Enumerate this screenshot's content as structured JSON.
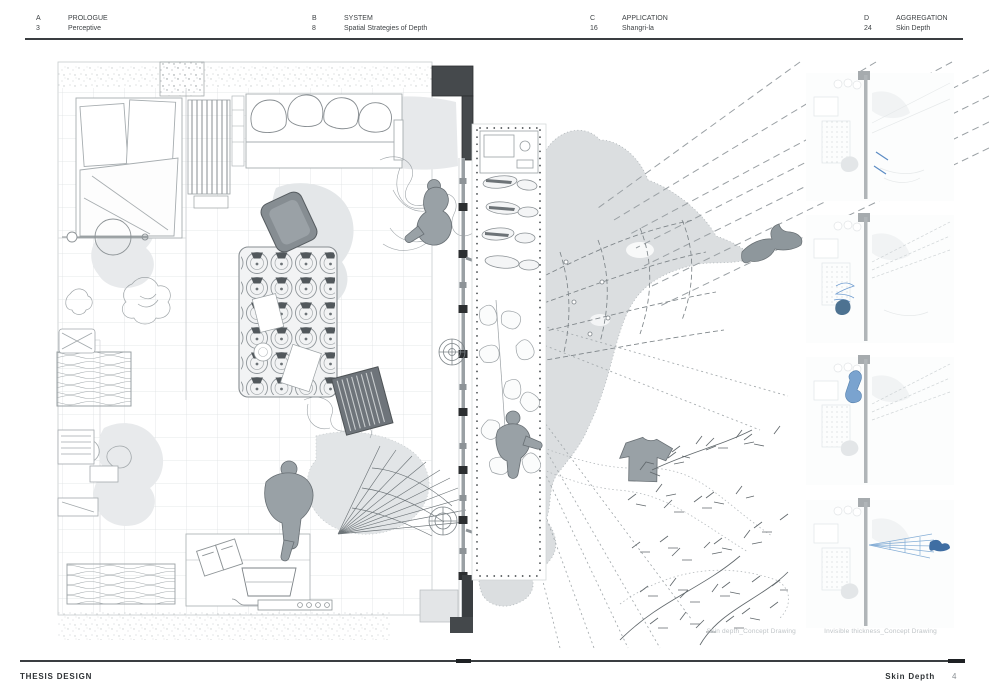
{
  "header": {
    "sections": [
      {
        "letter": "A",
        "number": "3",
        "title": "PROLOGUE",
        "subtitle": "Perceptive"
      },
      {
        "letter": "B",
        "number": "8",
        "title": "SYSTEM",
        "subtitle": "Spatial Strategies of Depth"
      },
      {
        "letter": "C",
        "number": "16",
        "title": "APPLICATION",
        "subtitle": "Shangri-la"
      },
      {
        "letter": "D",
        "number": "24",
        "title": "AGGREGATION",
        "subtitle": "Skin Depth"
      }
    ]
  },
  "main": {
    "captions": {
      "left": "Skin depth_Concept Drawing",
      "right": "Invisible thickness_Concept Drawing"
    }
  },
  "footer": {
    "left": "THESIS DESIGN",
    "right": "Skin Depth",
    "page": "4"
  },
  "colors": {
    "ink": "#3f4346",
    "light_line": "#dcdfe1",
    "blob_gray": "#dbdee0",
    "figure_gray": "#99a1a6",
    "wall_black": "#3a3e41",
    "accent_blue": "#5c8cc4"
  }
}
